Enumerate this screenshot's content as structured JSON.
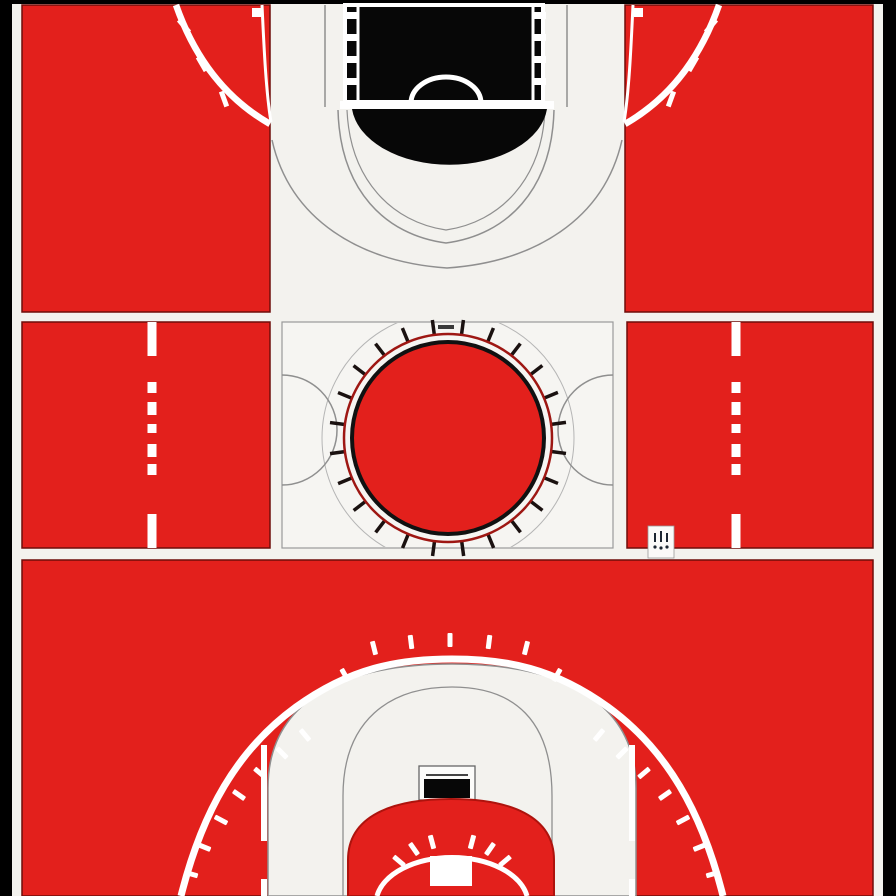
{
  "meta": {
    "description": "Stylized top-down basketball court diagram split into three horizontal panels: far-end key with black paint, center-court band with red center circle, and near-end half court with three-point arc",
    "style": "flat red, white and black illustration with black outer frame"
  },
  "colors": {
    "background": "#000000",
    "court_red": "#e3201c",
    "court_white": "#f3f2ee",
    "box_white": "#f6f5f2",
    "line_white": "#ffffff",
    "paint_black": "#070707",
    "thin_line_gray": "#8f8f8f",
    "dark_red_line": "#9e1713",
    "glyph_dark": "#1c2530"
  },
  "panels": {
    "top": {
      "name": "far-end half court",
      "paint_hash_marks_per_side": 4,
      "hash_geometry": {
        "left_x": 346,
        "right_x": 534,
        "first_y": 12,
        "spacing": 22,
        "width": 12,
        "height": 7
      },
      "three_point_ticks_per_side": 3
    },
    "middle": {
      "name": "center court band",
      "center_circle": {
        "tick_count": 24,
        "cx": 448,
        "cy": 438,
        "inner_radius": 104,
        "outer_radius": 119
      },
      "lane_dash_lines": {
        "x_positions": [
          152,
          736
        ],
        "segments": [
          [
            322,
            34
          ],
          [
            382,
            11
          ],
          [
            402,
            13
          ],
          [
            424,
            9
          ],
          [
            444,
            13
          ],
          [
            464,
            11
          ],
          [
            514,
            34
          ]
        ],
        "width": 9
      },
      "logo_badge": {
        "icon": "crown-like-mark",
        "strokes": 3,
        "dots": 3
      }
    },
    "bottom": {
      "name": "near-end half court",
      "three_point_ticks": {
        "top": 5,
        "shoulders": 2,
        "left": 7,
        "right": 7
      },
      "free_throw_arc_ticks": 6
    }
  }
}
